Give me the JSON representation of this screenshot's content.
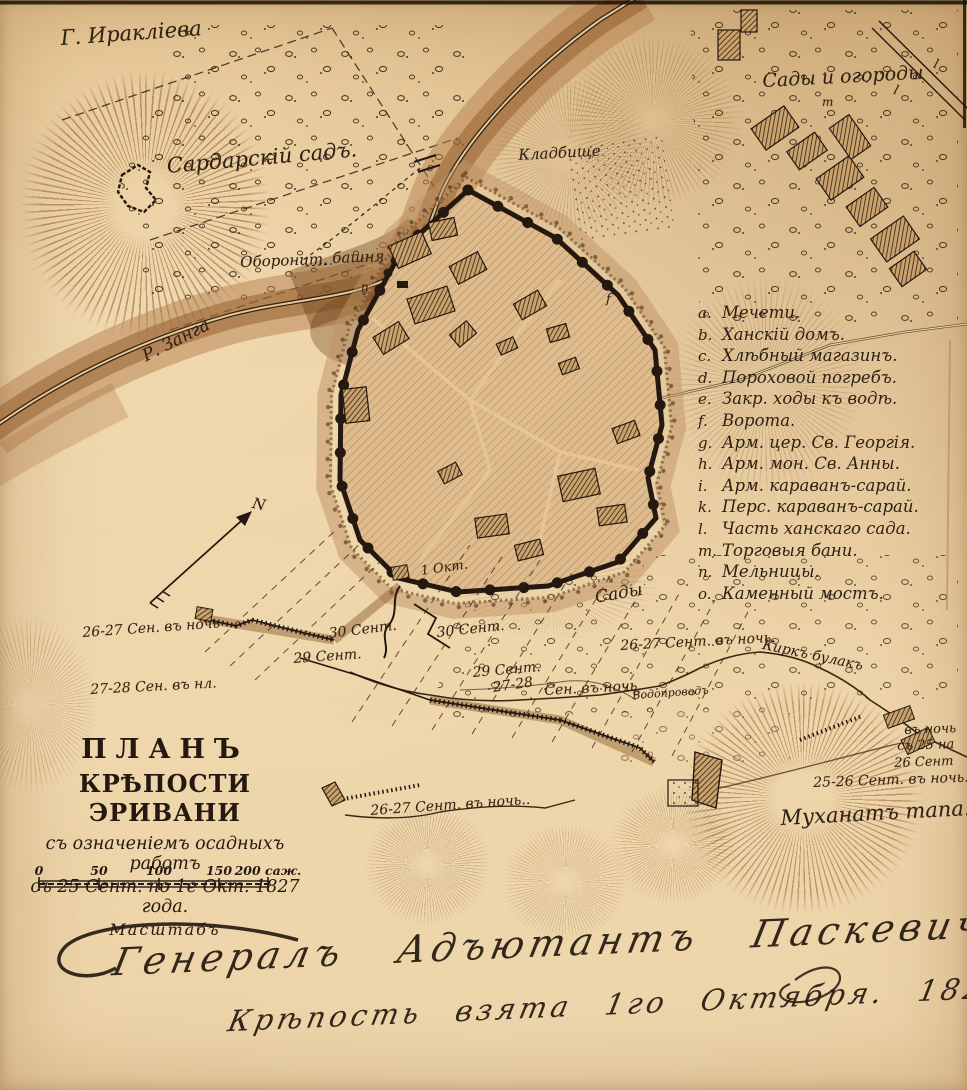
{
  "map": {
    "title_block": {
      "line1": "ПЛАНЪ",
      "line2": "КРѢПОСТИ ЭРИВАНИ",
      "line3": "съ означеніемъ осадныхъ работъ",
      "line4": "съ 25 Сент. по 1е Окт. 1827 года.",
      "scale_label": "Масштабъ",
      "scale_unit": "саж.",
      "scale_ticks": [
        {
          "label": "0",
          "x": 39
        },
        {
          "label": "50",
          "x": 99
        },
        {
          "label": "100",
          "x": 159
        },
        {
          "label": "150",
          "x": 219
        },
        {
          "label": "200 саж.",
          "x": 268
        }
      ]
    },
    "legend": {
      "items": [
        {
          "key": "a.",
          "label": "Мечети."
        },
        {
          "key": "b.",
          "label": "Ханскій домъ."
        },
        {
          "key": "c.",
          "label": "Хлѣбный магазинъ."
        },
        {
          "key": "d.",
          "label": "Пороховой погребъ."
        },
        {
          "key": "e.",
          "label": "Закр. ходы къ водѣ."
        },
        {
          "key": "f.",
          "label": "Ворота."
        },
        {
          "key": "g.",
          "label": "Арм. цер. Св. Георгія."
        },
        {
          "key": "h.",
          "label": "Арм. мон. Св. Анны."
        },
        {
          "key": "i.",
          "label": "Арм. караванъ-сарай."
        },
        {
          "key": "k.",
          "label": "Перс. караванъ-сарай."
        },
        {
          "key": "l.",
          "label": "Часть ханскаго сада."
        },
        {
          "key": "m.",
          "label": "Торговыя бани."
        },
        {
          "key": "n.",
          "label": "Мельницы."
        },
        {
          "key": "o.",
          "label": "Каменный мостъ."
        }
      ]
    },
    "place_labels": [
      {
        "name": "label-mount-iraklieva",
        "text": "Г. Иракліева",
        "x": 60,
        "y": 28,
        "size": 21,
        "rot": -4
      },
      {
        "name": "label-sardar-garden",
        "text": "Сардарскій садъ.",
        "x": 166,
        "y": 156,
        "size": 21,
        "rot": -5
      },
      {
        "name": "label-cemetery",
        "text": "Кладбище",
        "x": 518,
        "y": 148,
        "size": 15,
        "rot": -3
      },
      {
        "name": "label-defensive-tower-word1",
        "text": "Оборонит.",
        "x": 240,
        "y": 255,
        "size": 15,
        "rot": -2
      },
      {
        "name": "label-defensive-tower-word2",
        "text": "башня",
        "x": 332,
        "y": 251,
        "size": 15,
        "rot": -2
      },
      {
        "name": "label-zanga-river",
        "text": "Р. Занга",
        "x": 140,
        "y": 350,
        "size": 17,
        "rot": -27
      },
      {
        "name": "label-gardens-orchards",
        "text": "Сады и огороды",
        "x": 762,
        "y": 72,
        "size": 19,
        "rot": -3
      },
      {
        "name": "label-gardens",
        "text": "Сады",
        "x": 594,
        "y": 590,
        "size": 17,
        "rot": -10
      },
      {
        "name": "label-kirkh-bulak-stream",
        "text": "Киркъ булакъ",
        "x": 764,
        "y": 638,
        "size": 14,
        "rot": 12
      },
      {
        "name": "label-aqueduct",
        "text": "Водопроводъ",
        "x": 632,
        "y": 690,
        "size": 11,
        "rot": -4
      },
      {
        "name": "label-muhanat-tapa",
        "text": "Муханатъ тапа.",
        "x": 780,
        "y": 808,
        "size": 21,
        "rot": -3
      }
    ],
    "siege_labels": [
      {
        "name": "label-siege-2627-west",
        "text": "26-27 Сен. въ ночь",
        "x": 82,
        "y": 626,
        "size": 14,
        "rot": -4
      },
      {
        "name": "label-siege-2728-west",
        "text": "27-28 Сен. въ нл.",
        "x": 90,
        "y": 683,
        "size": 14,
        "rot": -3
      },
      {
        "name": "label-siege-30-west",
        "text": "30 Сент.",
        "x": 328,
        "y": 627,
        "size": 14,
        "rot": -7
      },
      {
        "name": "label-siege-29-west",
        "text": "29 Сент.",
        "x": 293,
        "y": 652,
        "size": 14,
        "rot": -4
      },
      {
        "name": "label-siege-1-okt",
        "text": "1 Окт.",
        "x": 420,
        "y": 565,
        "size": 13,
        "rot": -8
      },
      {
        "name": "label-siege-30-east",
        "text": "30 Сент.",
        "x": 436,
        "y": 626,
        "size": 14,
        "rot": -6
      },
      {
        "name": "label-siege-29-east",
        "text": "29 Сент.",
        "x": 472,
        "y": 666,
        "size": 14,
        "rot": -5
      },
      {
        "name": "label-siege-2728-east-1",
        "text": "27-28",
        "x": 492,
        "y": 681,
        "size": 14,
        "rot": -8
      },
      {
        "name": "label-siege-2728-east-2",
        "text": "Сен. въ ночь.",
        "x": 544,
        "y": 684,
        "size": 14,
        "rot": -3
      },
      {
        "name": "label-siege-2627-mid",
        "text": "26-27 Сент. въ ночь.",
        "x": 620,
        "y": 639,
        "size": 14,
        "rot": -3
      },
      {
        "name": "label-siege-2627-south",
        "text": "26-27 Сент. въ ночь..",
        "x": 370,
        "y": 804,
        "size": 14,
        "rot": -4
      },
      {
        "name": "label-night-2526-line1",
        "text": "въ ночь",
        "x": 904,
        "y": 724,
        "size": 13,
        "rot": -2
      },
      {
        "name": "label-night-2526-line2",
        "text": "съ 25 на",
        "x": 897,
        "y": 740,
        "size": 13,
        "rot": -2
      },
      {
        "name": "label-night-2526-line3",
        "text": "26 Сент",
        "x": 894,
        "y": 757,
        "size": 13,
        "rot": -2
      },
      {
        "name": "label-siege-2526",
        "text": "25-26 Сент. въ ночь.",
        "x": 813,
        "y": 776,
        "size": 14,
        "rot": -2
      }
    ],
    "letter_marks": [
      {
        "name": "compass-north-label",
        "text": "N",
        "x": 254,
        "y": 496,
        "size": 15,
        "rot": 12
      },
      {
        "name": "mark-f-gate",
        "text": "f",
        "x": 606,
        "y": 293,
        "size": 13,
        "rot": 0
      },
      {
        "name": "mark-n-mill",
        "text": "n",
        "x": 361,
        "y": 281,
        "size": 12,
        "rot": 0
      },
      {
        "name": "mark-m-baths",
        "text": "m",
        "x": 822,
        "y": 96,
        "size": 12,
        "rot": 0
      },
      {
        "name": "mark-l-khan-garden-1",
        "text": "l",
        "x": 896,
        "y": 84,
        "size": 13,
        "rot": 18
      },
      {
        "name": "mark-l-khan-garden-2",
        "text": "l",
        "x": 936,
        "y": 58,
        "size": 13,
        "rot": 18
      },
      {
        "name": "mark-o-stone-bridge",
        "text": "o",
        "x": 427,
        "y": 162,
        "size": 11,
        "rot": 0
      }
    ],
    "signature": {
      "line1": "Генералъ Адъютантъ Паскевичъ",
      "line2": "Крѣпость взята 1го Октября. 1827. —"
    }
  },
  "colors": {
    "paper": "#e9cda0",
    "ink": "#241811",
    "hachure": "#764014",
    "river_band": "#8a5424"
  }
}
